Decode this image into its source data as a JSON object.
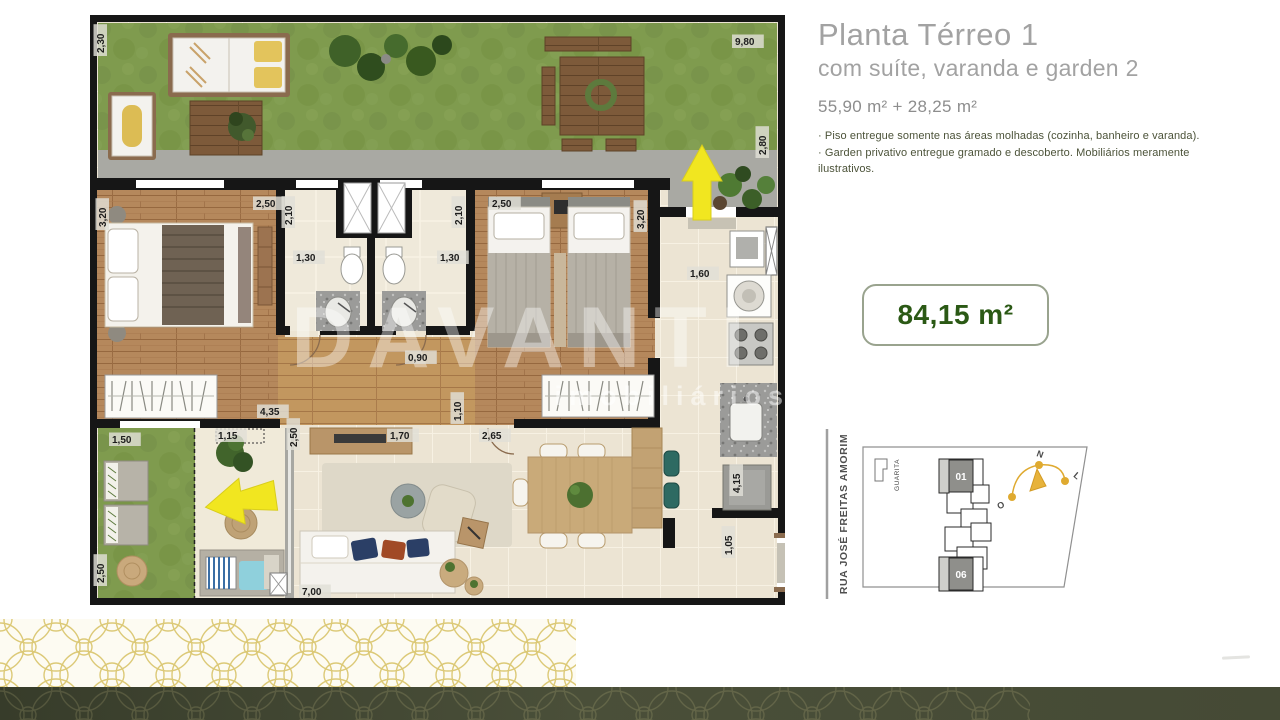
{
  "header": {
    "title": "Planta Térreo 1",
    "subtitle": "com suíte, varanda e garden 2",
    "area_line": "55,90 m² + 28,25 m²",
    "notes": [
      "· Piso entregue somente nas áreas molhadas (cozinha, banheiro e varanda).",
      "· Garden privativo entregue gramado e descoberto. Mobiliários meramente ilustrativos."
    ]
  },
  "area_badge": {
    "value": "84,15 m²"
  },
  "floor_plan": {
    "watermark_primary": "DAVANTI",
    "watermark_secondary": "imobiliários",
    "dimensions": [
      {
        "t": "2,30",
        "x": 14,
        "y": 38,
        "v": 1
      },
      {
        "t": "9,80",
        "x": 645,
        "y": 30,
        "v": 0
      },
      {
        "t": "2,80",
        "x": 676,
        "y": 140,
        "v": 1
      },
      {
        "t": "3,20",
        "x": 16,
        "y": 212,
        "v": 1
      },
      {
        "t": "2,50",
        "x": 166,
        "y": 192,
        "v": 0
      },
      {
        "t": "2,10",
        "x": 202,
        "y": 210,
        "v": 1
      },
      {
        "t": "1,30",
        "x": 206,
        "y": 246,
        "v": 0
      },
      {
        "t": "2,10",
        "x": 372,
        "y": 210,
        "v": 1
      },
      {
        "t": "1,30",
        "x": 350,
        "y": 246,
        "v": 0
      },
      {
        "t": "2,50",
        "x": 402,
        "y": 192,
        "v": 0
      },
      {
        "t": "3,20",
        "x": 554,
        "y": 214,
        "v": 1
      },
      {
        "t": "0,90",
        "x": 318,
        "y": 346,
        "v": 0
      },
      {
        "t": "4,35",
        "x": 170,
        "y": 400,
        "v": 0
      },
      {
        "t": "1,10",
        "x": 371,
        "y": 406,
        "v": 1
      },
      {
        "t": "1,60",
        "x": 600,
        "y": 262,
        "v": 0
      },
      {
        "t": "1,50",
        "x": 22,
        "y": 428,
        "v": 0
      },
      {
        "t": "1,15",
        "x": 128,
        "y": 424,
        "v": 0
      },
      {
        "t": "2,50",
        "x": 14,
        "y": 568,
        "v": 1
      },
      {
        "t": "2,50",
        "x": 207,
        "y": 432,
        "v": 1
      },
      {
        "t": "1,70",
        "x": 300,
        "y": 424,
        "v": 0
      },
      {
        "t": "2,65",
        "x": 392,
        "y": 424,
        "v": 0
      },
      {
        "t": "7,00",
        "x": 212,
        "y": 580,
        "v": 0
      },
      {
        "t": "4,15",
        "x": 650,
        "y": 478,
        "v": 1
      },
      {
        "t": "1,05",
        "x": 642,
        "y": 540,
        "v": 1
      }
    ]
  },
  "site_map": {
    "street": "RUA JOSÉ FREITAS AMORIM",
    "guardhouse_label": "GUARITA",
    "unit_top": "01",
    "unit_bottom": "06",
    "compass": {
      "north": "N",
      "west": "O",
      "east": "L"
    }
  },
  "colors": {
    "accent_green": "#2b5915",
    "note_green": "#4c5339",
    "title_gray": "#a2a2a2",
    "pattern_gold": "#dcc977",
    "footer_olive": "#4a4f39",
    "arrow_yellow": "#f1e620",
    "grass_green": "#7f9b4e"
  }
}
